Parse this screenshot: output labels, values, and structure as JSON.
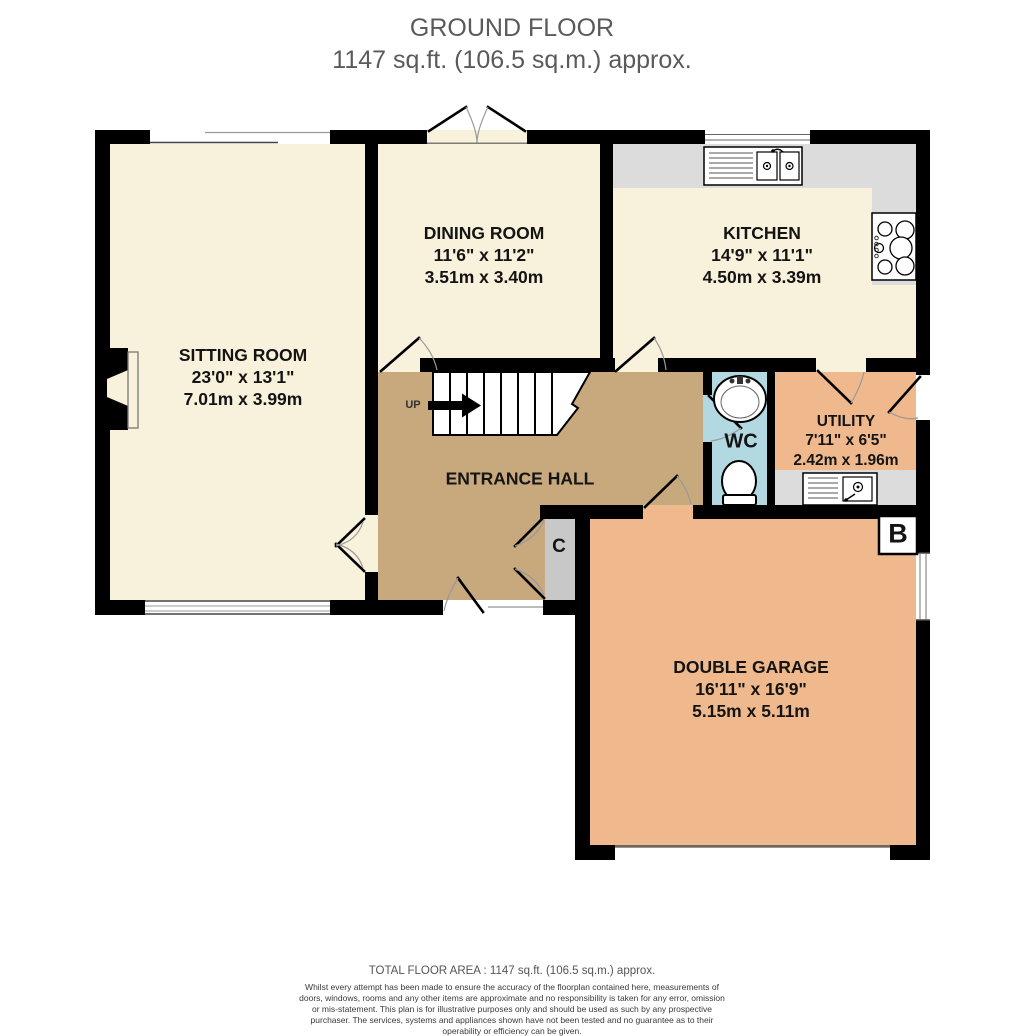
{
  "title": {
    "line1": "GROUND FLOOR",
    "line2": "1147 sq.ft. (106.5 sq.m.) approx."
  },
  "rooms": {
    "sitting": {
      "name": "SITTING ROOM",
      "imperial": "23'0\" x 13'1\"",
      "metric": "7.01m x 3.99m"
    },
    "dining": {
      "name": "DINING ROOM",
      "imperial": "11'6\" x 11'2\"",
      "metric": "3.51m x 3.40m"
    },
    "kitchen": {
      "name": "KITCHEN",
      "imperial": "14'9\" x 11'1\"",
      "metric": "4.50m x 3.39m"
    },
    "utility": {
      "name": "UTILITY",
      "imperial": "7'11\" x 6'5\"",
      "metric": "2.42m x 1.96m"
    },
    "wc": {
      "name": "WC"
    },
    "hall": {
      "name": "ENTRANCE HALL"
    },
    "garage": {
      "name": "DOUBLE GARAGE",
      "imperial": "16'11\" x 16'9\"",
      "metric": "5.15m x 5.11m"
    }
  },
  "markers": {
    "up": "UP",
    "closet": "C",
    "boiler": "B"
  },
  "footer": {
    "total": "TOTAL FLOOR AREA : 1147 sq.ft. (106.5 sq.m.) approx.",
    "disclaimer": "Whilst every attempt has been made to ensure the accuracy of the floorplan contained here, measurements of doors, windows, rooms and any other items are approximate and no responsibility is taken for any error, omission or mis-statement. This plan is for illustrative purposes only and should be used as such by any prospective purchaser. The services, systems and appliances shown have not been tested and no guarantee as to their operability or efficiency can be given.",
    "credit": "Made with Metropix ©2025"
  },
  "colors": {
    "room_cream": "#F8F1DB",
    "hall_tan": "#C8A87D",
    "garage_orange": "#EFB98D",
    "wc_blue": "#B2D9E2",
    "counter_gray": "#DCDCDC",
    "closet_gray": "#C8C8C8",
    "wall": "#000000",
    "title_gray": "#5A5A5A"
  },
  "fixtures": [
    "staircase-up",
    "fireplace",
    "kitchen-sink",
    "hob",
    "utility-sink",
    "wash-basin",
    "toilet",
    "boiler-marker",
    "cupboard",
    "garage-door",
    "window",
    "door"
  ]
}
